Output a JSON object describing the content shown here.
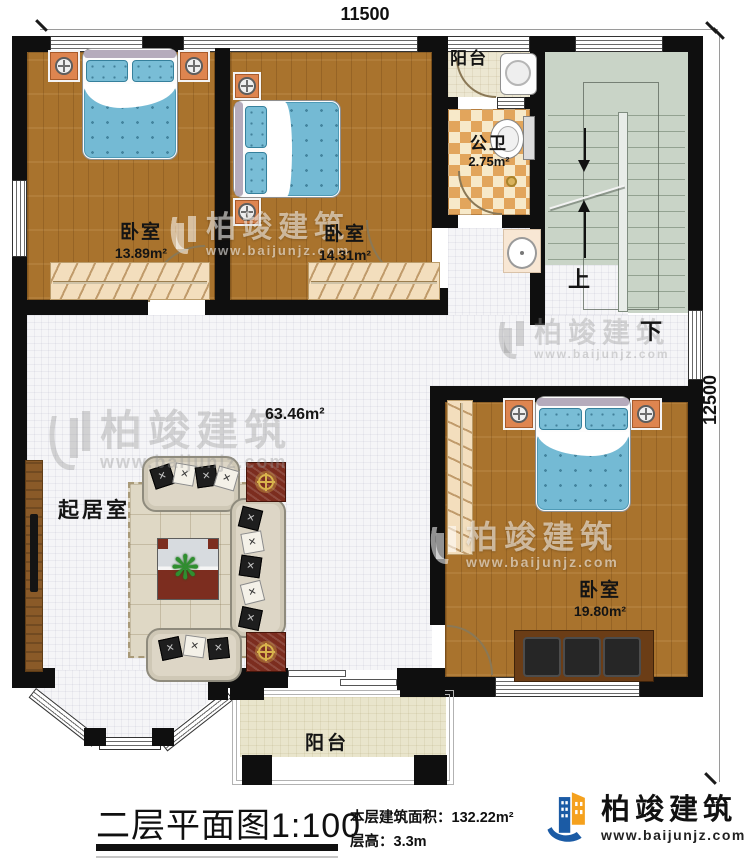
{
  "plan": {
    "dimension_top": "11500",
    "dimension_right": "12500"
  },
  "rooms": {
    "bedroom1": {
      "name": "卧室",
      "area": "13.89m²"
    },
    "bedroom2": {
      "name": "卧室",
      "area": "14.31m²"
    },
    "bedroom3": {
      "name": "卧室",
      "area": "19.80m²"
    },
    "bathroom": {
      "name": "公卫",
      "area": "2.75m²"
    },
    "living_room": {
      "name": "起居室",
      "area": "63.46m²"
    },
    "balcony_top": {
      "name": "阳台"
    },
    "balcony_bottom": {
      "name": "阳台"
    }
  },
  "stairs": {
    "up_label": "上",
    "down_label": "下"
  },
  "title_block": {
    "title": "二层平面图1:100",
    "floor_area_label": "本层建筑面积：132.22m²",
    "floor_height_label": "层高：3.3m"
  },
  "brand": {
    "name": "柏竣建筑",
    "website": "www.baijunjz.com"
  },
  "watermark": {
    "name": "柏竣建筑",
    "website": "www.baijunjz.com"
  },
  "colors": {
    "wall": "#0f0f0f",
    "wood_floor": "#a9732d",
    "tile_floor": "#f5f5f7",
    "bed_blue": "#74bad4",
    "bath_tile_orange": "#e2a55c",
    "stair_green": "#c9d4c7",
    "balcony_tile": "#ece7d2",
    "accent_maroon": "#7c2d1f",
    "brand_blue": "#1b5ba5",
    "brand_orange": "#f5a11d"
  }
}
